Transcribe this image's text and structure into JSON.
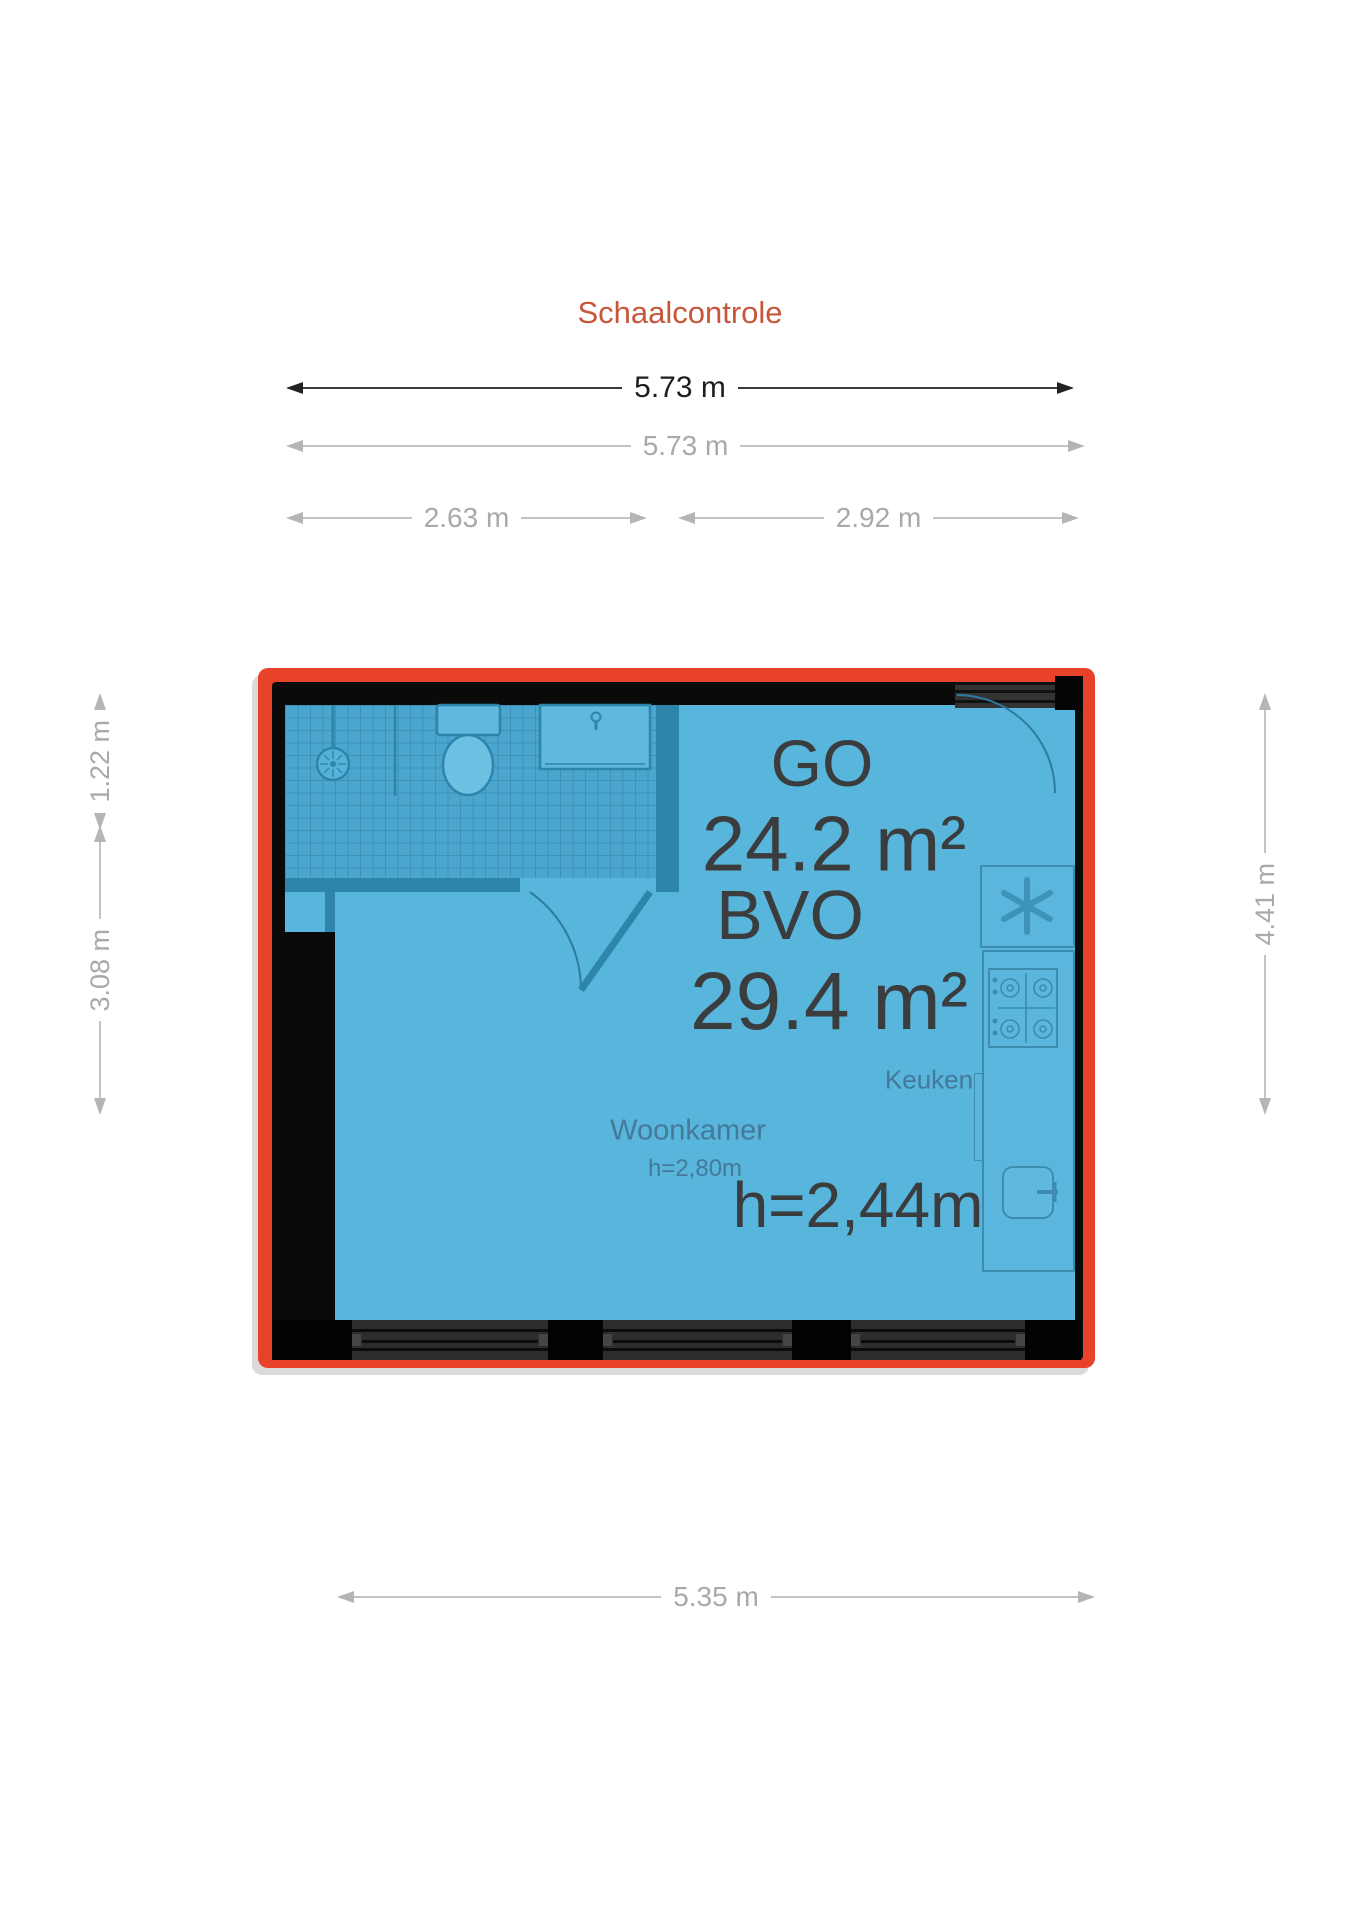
{
  "title": "Schaalcontrole",
  "colors": {
    "accent_red": "#e8432a",
    "wall_black": "#0a0a0a",
    "room_blue": "#58b5db",
    "bathroom_tile_blue": "#4ba6cd",
    "partition_teal": "#2d85ac",
    "big_text_gray": "#3a3c3e",
    "room_label_blue_gray": "#45799a",
    "dim_gray": "#a9a9a9",
    "title_orange": "#c8563b"
  },
  "dimensions": {
    "overall_width_primary": "5.73 m",
    "overall_width_secondary": "5.73 m",
    "width_left_part": "2.63 m",
    "width_right_part": "2.92 m",
    "left_upper_height": "1.22 m",
    "left_lower_height": "3.08 m",
    "right_height": "4.41 m",
    "bottom_width": "5.35 m"
  },
  "floorplan": {
    "area_labels": {
      "go_label": "GO",
      "go_value": "24.2 m²",
      "bvo_label": "BVO",
      "bvo_value": "29.4 m²"
    },
    "ceiling_height_overall": "h=2,44m",
    "rooms": {
      "living": {
        "name": "Woonkamer",
        "ceiling_height": "h=2,80m"
      },
      "kitchen": {
        "name": "Keuken"
      }
    },
    "fixtures": [
      "shower",
      "toilet",
      "washbasin",
      "ventilation-fan",
      "stove",
      "kitchen-sink",
      "entrance-door",
      "bathroom-door",
      "windows"
    ]
  }
}
